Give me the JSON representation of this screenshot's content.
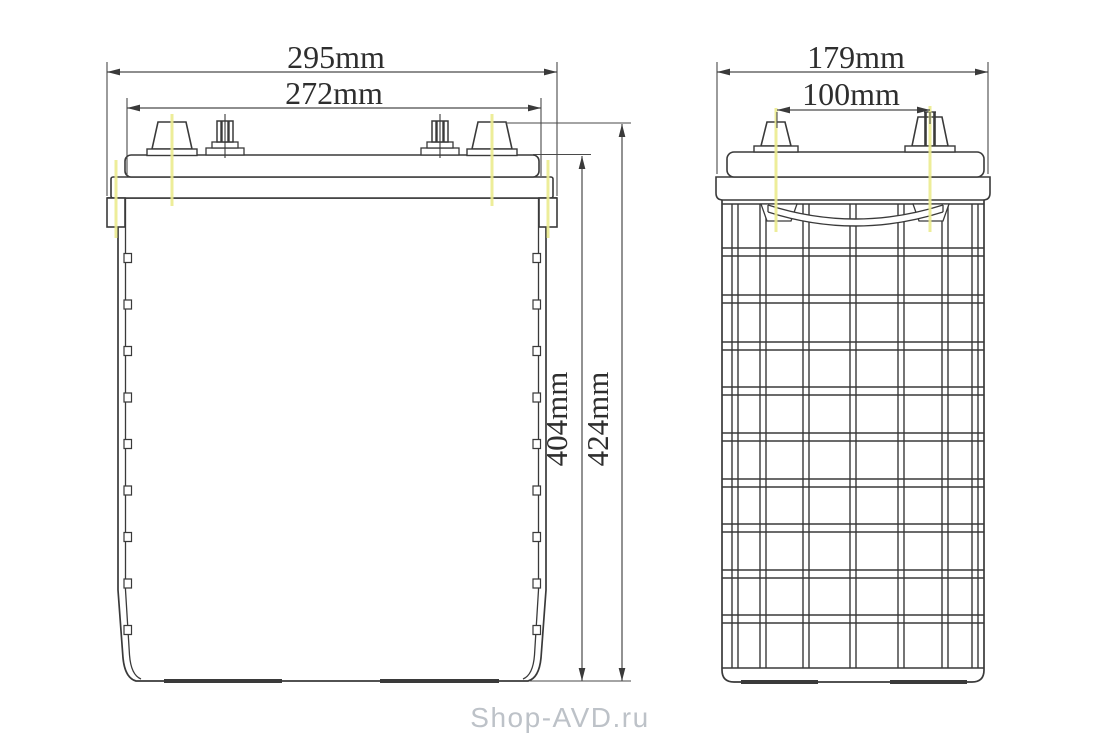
{
  "drawing": {
    "kind": "battery-dimensional-drawing",
    "front_view": {
      "dimensions": {
        "overall_width": {
          "label": "295mm"
        },
        "case_width": {
          "label": "272mm"
        },
        "case_height": {
          "label": "404mm"
        },
        "overall_height": {
          "label": "424mm"
        }
      }
    },
    "side_view": {
      "dimensions": {
        "overall_depth": {
          "label": "179mm"
        },
        "terminal_spacing": {
          "label": "100mm"
        }
      }
    },
    "colors": {
      "line": "#3a3a3a",
      "dimension_line": "#4a4a4a",
      "centerline_yellow": "#ebeb8e",
      "text": "#2e2e2e",
      "watermark": "#bdc2c8",
      "background": "#ffffff"
    }
  },
  "watermark": {
    "text": "Shop-AVD.ru"
  }
}
